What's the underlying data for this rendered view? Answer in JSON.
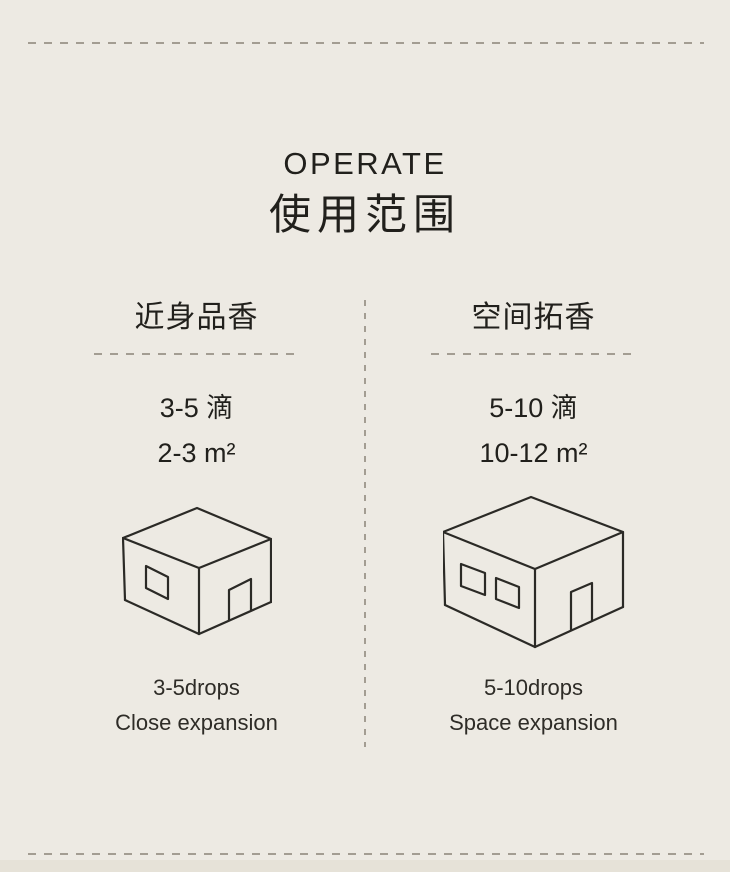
{
  "page": {
    "colors": {
      "bg": "#edeae3",
      "footer": "#e6e2d8",
      "dash": "#a39d92",
      "ink": "#21201c",
      "line": "#2b2a26"
    }
  },
  "header": {
    "title_en": "OPERATE",
    "title_zh": "使用范围"
  },
  "columns": [
    {
      "heading": "近身品香",
      "drops_zh": "3-5 滴",
      "area": "2-3 m²",
      "drops_en": "3-5drops",
      "caption_en": "Close expansion",
      "house_icon": "small-house-icon"
    },
    {
      "heading": "空间拓香",
      "drops_zh": "5-10 滴",
      "area": "10-12 m²",
      "drops_en": "5-10drops",
      "caption_en": "Space expansion",
      "house_icon": "large-house-icon"
    }
  ]
}
